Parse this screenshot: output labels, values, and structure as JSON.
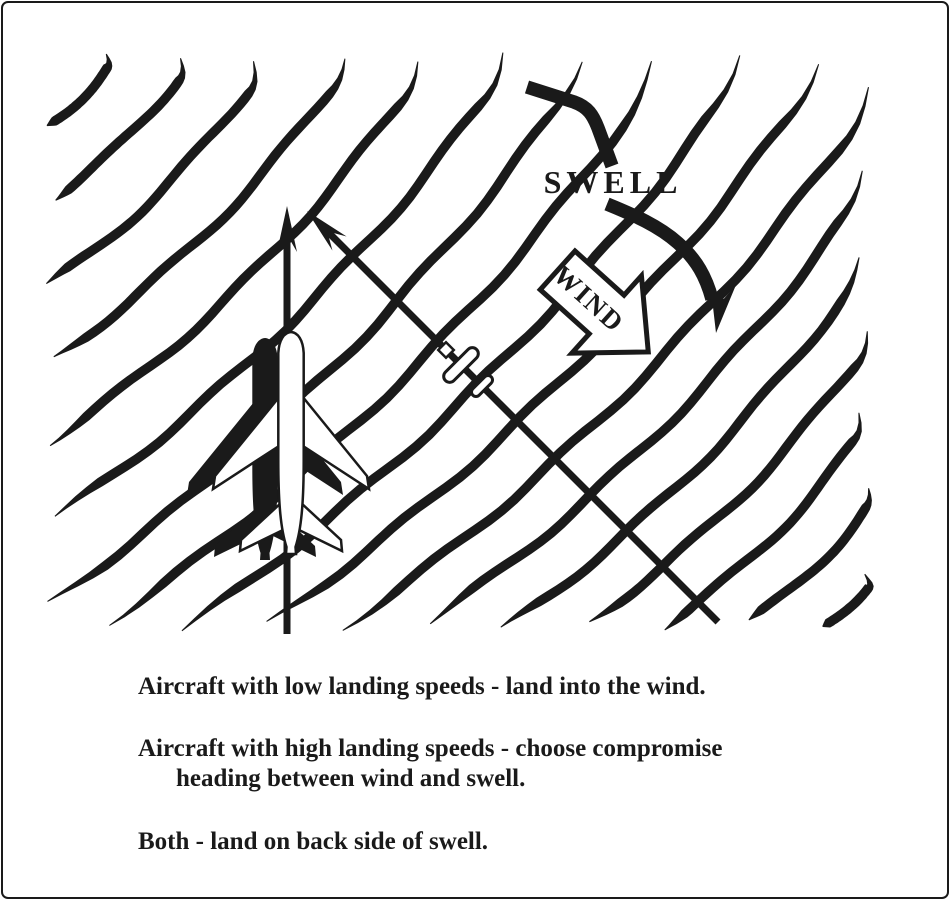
{
  "page": {
    "background": "#ffffff",
    "ink_color": "#1a1a1a",
    "description": "Wind-swell ditching heading diagram"
  },
  "diagram": {
    "swell_label": "SWELL",
    "wind_label": "WIND"
  },
  "captions": {
    "low_speed": "Aircraft with low landing speeds - land into the wind.",
    "high_speed_line1": "Aircraft with high landing speeds - choose compromise",
    "high_speed_line2": "heading between wind and swell.",
    "both": "Both - land on back side of swell."
  }
}
